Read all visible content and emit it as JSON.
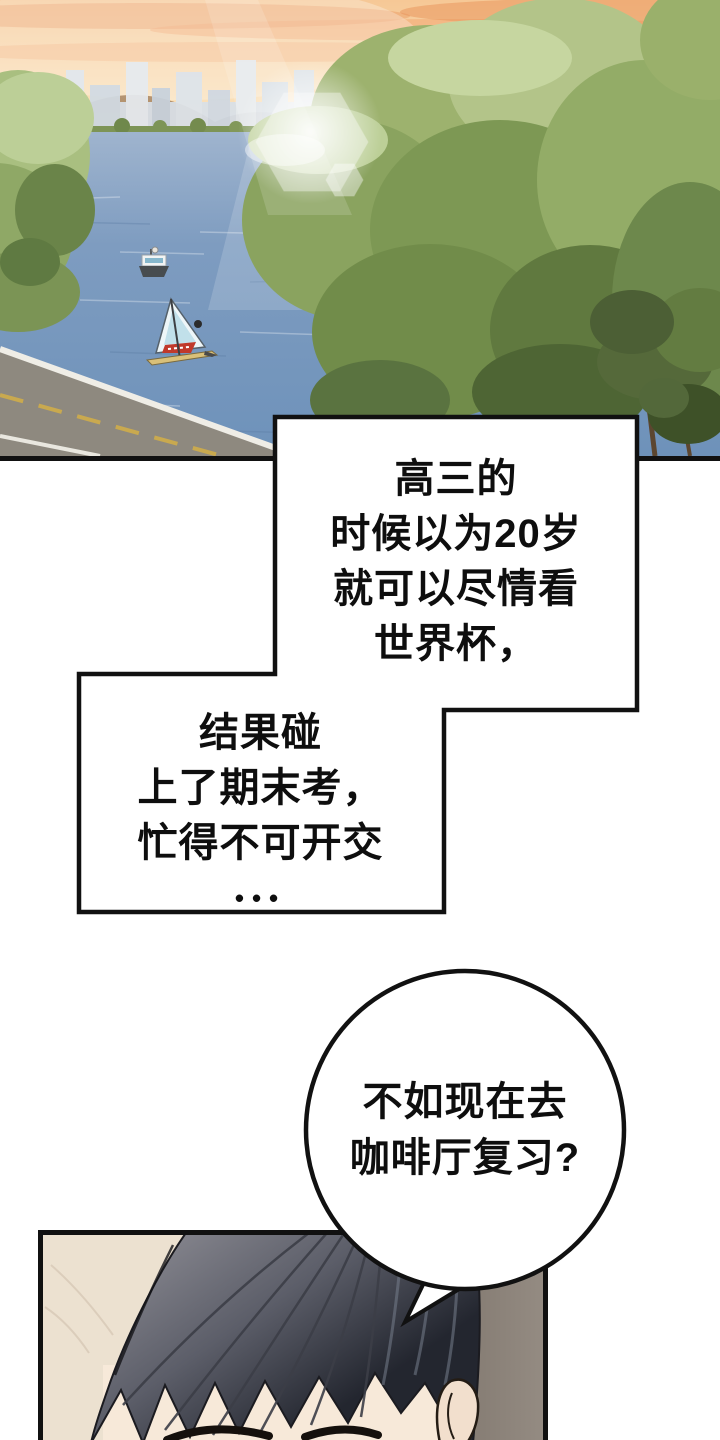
{
  "bubbles": {
    "b1": {
      "lines": [
        "高三的",
        "时候以为20岁",
        "就可以尽情看",
        "世界杯，"
      ]
    },
    "b2": {
      "lines": [
        "结果碰",
        "上了期末考，",
        "忙得不可开交",
        "•••"
      ]
    },
    "b3": {
      "lines": [
        "不如现在去",
        "咖啡厅复习?"
      ]
    }
  },
  "colors": {
    "ink": "#111111",
    "paper": "#ffffff",
    "sky": "#f7cf9f",
    "water": "#6e92ba",
    "foliage": "#8aa35f",
    "road": "#8e897f",
    "wall_gray": "#8a8177",
    "wall_cream": "#ece1d0",
    "hair_dark": "#23262f"
  }
}
